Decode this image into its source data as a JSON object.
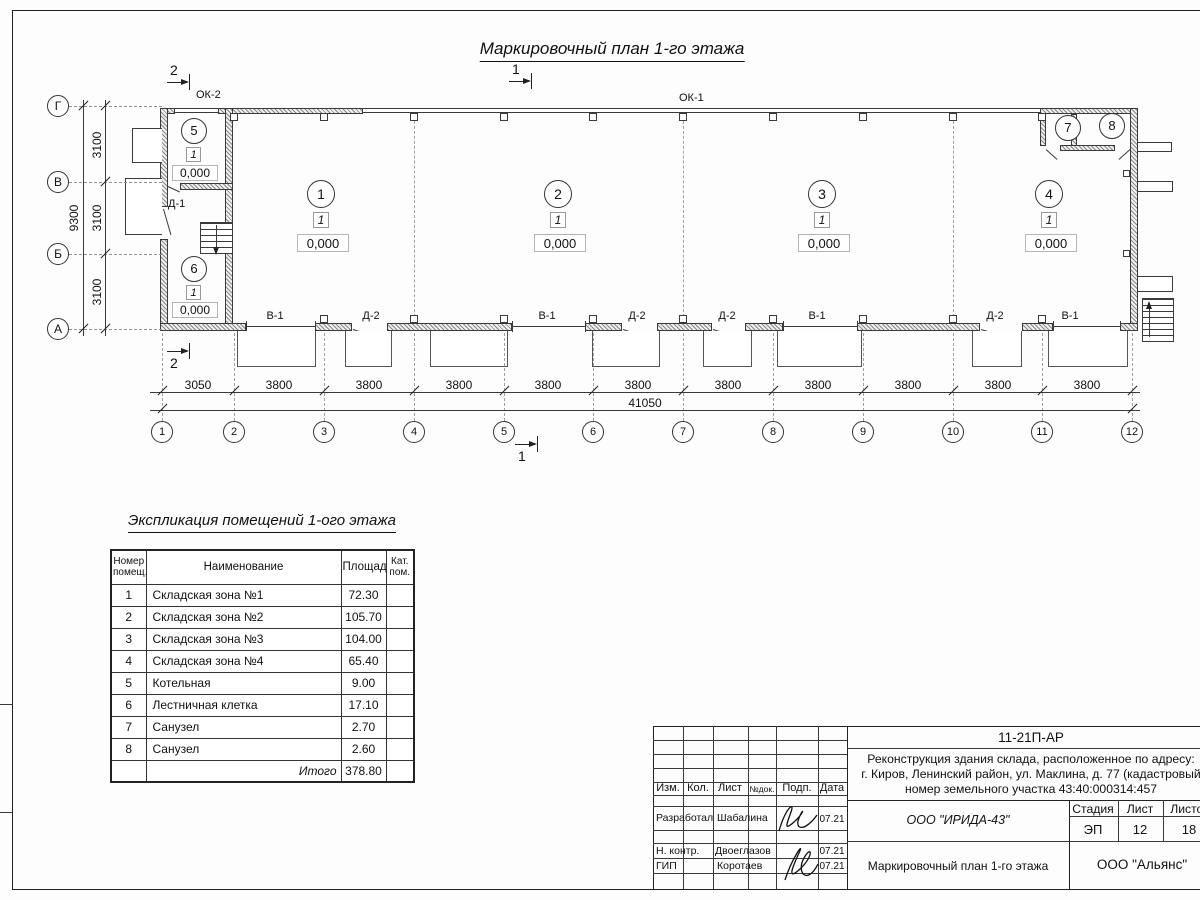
{
  "page": {
    "title": "Маркировочный план 1-го этажа"
  },
  "plan": {
    "labels": {
      "ok2": "ОК-2",
      "ok1": "ОК-1",
      "d1": "Д-1"
    },
    "rooms": [
      {
        "num": "1",
        "cat": "1",
        "elev": "0,000"
      },
      {
        "num": "2",
        "cat": "1",
        "elev": "0,000"
      },
      {
        "num": "3",
        "cat": "1",
        "elev": "0,000"
      },
      {
        "num": "4",
        "cat": "1",
        "elev": "0,000"
      },
      {
        "num": "5",
        "cat": "1",
        "elev": "0,000"
      },
      {
        "num": "6",
        "cat": "1",
        "elev": "0,000"
      },
      {
        "num": "7"
      },
      {
        "num": "8"
      }
    ],
    "openings": [
      "В-1",
      "Д-2",
      "В-1",
      "Д-2",
      "Д-2",
      "В-1",
      "Д-2",
      "В-1"
    ],
    "sections": {
      "s2": "2",
      "s1": "1"
    },
    "h_dims": {
      "segments": [
        "3050",
        "3800",
        "3800",
        "3800",
        "3800",
        "3800",
        "3800",
        "3800",
        "3800",
        "3800",
        "3800"
      ],
      "total": "41050"
    },
    "v_dims": {
      "segments": [
        "3100",
        "3100",
        "3100"
      ],
      "total": "9300"
    },
    "axis_numbers": [
      "1",
      "2",
      "3",
      "4",
      "5",
      "6",
      "7",
      "8",
      "9",
      "10",
      "11",
      "12"
    ],
    "axis_letters": [
      "Г",
      "В",
      "Б",
      "А"
    ]
  },
  "explication": {
    "title": "Экспликация помещений 1-ого этажа",
    "headers": {
      "num": "Номер помещ.",
      "name": "Наименование",
      "area": "Площадь",
      "cat": "Кат. пом."
    },
    "rows": [
      {
        "num": "1",
        "name": "Складская зона №1",
        "area": "72.30"
      },
      {
        "num": "2",
        "name": "Складская зона №2",
        "area": "105.70"
      },
      {
        "num": "3",
        "name": "Складская зона №3",
        "area": "104.00"
      },
      {
        "num": "4",
        "name": "Складская зона №4",
        "area": "65.40"
      },
      {
        "num": "5",
        "name": "Котельная",
        "area": "9.00"
      },
      {
        "num": "6",
        "name": "Лестничная клетка",
        "area": "17.10"
      },
      {
        "num": "7",
        "name": "Санузел",
        "area": "2.70"
      },
      {
        "num": "8",
        "name": "Санузел",
        "area": "2.60"
      }
    ],
    "total_label": "Итого",
    "total_value": "378.80"
  },
  "titleblock": {
    "doc_number": "11-21П-АР",
    "project_line1": "Реконструкция здания склада, расположенное по адресу:",
    "project_line2": "г. Киров, Ленинский район, ул. Маклина, д. 77 (кадастровый",
    "project_line3": "номер земельного участка 43:40:000314:457",
    "header_cells": [
      "Изм.",
      "Кол.",
      "Лист",
      "№док.",
      "Подп.",
      "Дата"
    ],
    "sign_rows": [
      {
        "role": "Разработал",
        "name": "Шабалина",
        "date": "07.21"
      },
      {
        "role": "Н. контр.",
        "name": "Двоеглазов",
        "date": "07.21"
      },
      {
        "role": "ГИП",
        "name": "Коротаев",
        "date": "07.21"
      }
    ],
    "org": "ООО \"ИРИДА-43\"",
    "sheet_title": "Маркировочный план 1-го этажа",
    "stage_label": "Стадия",
    "sheet_label": "Лист",
    "sheets_label": "Листов",
    "stage": "ЭП",
    "sheet_num": "12",
    "sheets_total": "18",
    "company": "ООО \"Альянс\""
  }
}
